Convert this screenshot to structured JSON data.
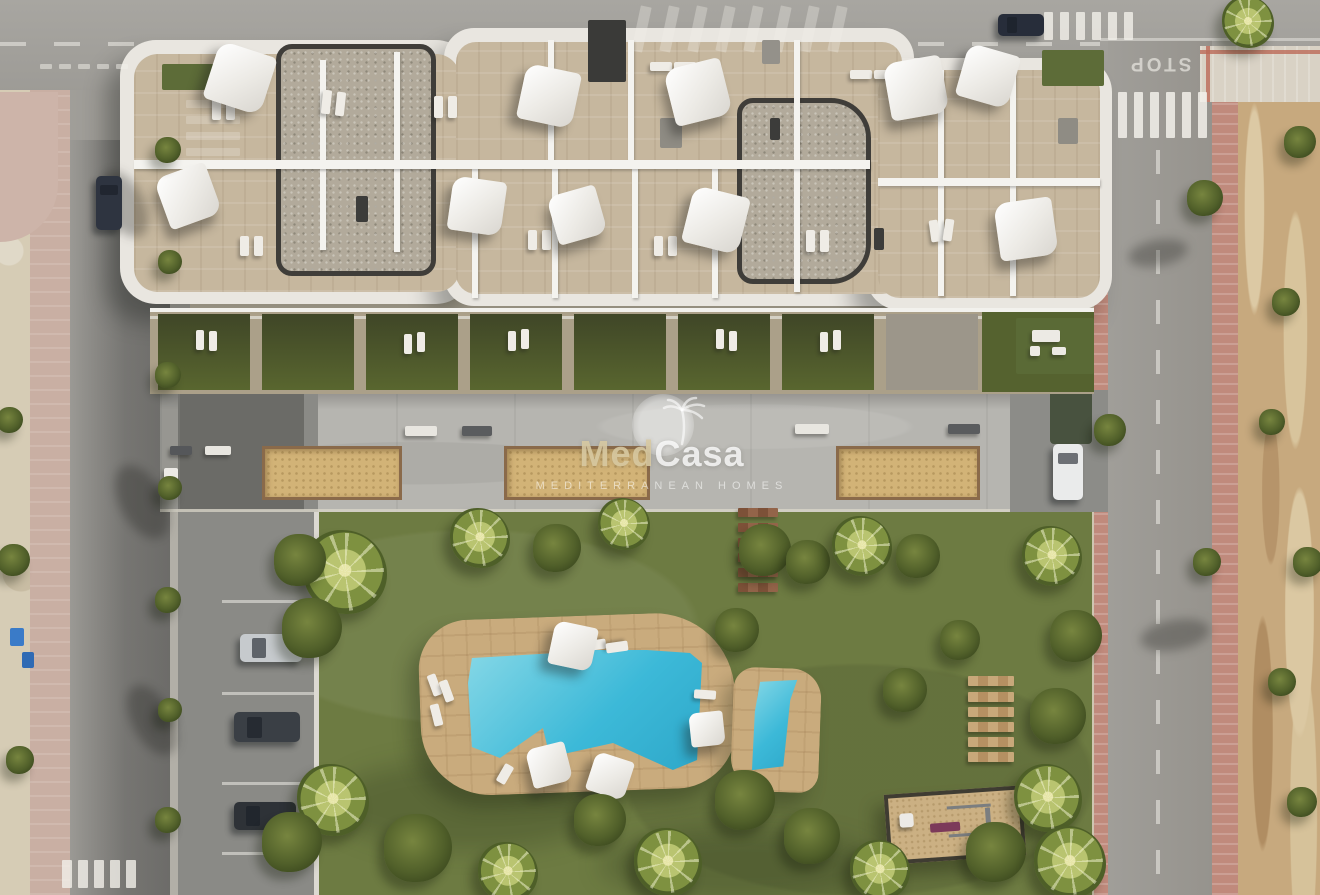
{
  "watermark": {
    "brand_part1": "Med",
    "brand_part2": "Casa",
    "tagline": "MEDITERRANEAN HOMES",
    "icon": "sun-palm-logo-icon",
    "brand_gold_color": "#d8c9a2",
    "watermark_white": "rgba(255,255,255,0.78)"
  },
  "road_markings": {
    "stop_text": "STOP"
  },
  "colors": {
    "pool_water": "#3cb9d8",
    "lawn": "#6d7b42",
    "pool_deck": "#c9ab7d",
    "planter_sand": "#d2b377",
    "roof_terrace": "#c6b79e",
    "roof_gravel": "#b2aa9b",
    "asphalt": "#9b9a96",
    "promenade": "#b6b5b0",
    "red_sidewalk": "#c08a7c",
    "vacant_dirt": "#c7a97e",
    "private_garden": "#4c5430",
    "fitness_bench_purple": "#7c3a5a"
  },
  "scene": {
    "parasols": [
      [
        240,
        78,
        60,
        18
      ],
      [
        188,
        196,
        54,
        -20
      ],
      [
        549,
        96,
        56,
        12
      ],
      [
        698,
        92,
        58,
        -14
      ],
      [
        477,
        206,
        54,
        8
      ],
      [
        577,
        215,
        50,
        -16
      ],
      [
        716,
        220,
        58,
        14
      ],
      [
        916,
        88,
        58,
        -10
      ],
      [
        988,
        76,
        54,
        16
      ],
      [
        1026,
        229,
        58,
        -8
      ],
      [
        573,
        646,
        44,
        12
      ],
      [
        549,
        765,
        40,
        -14
      ],
      [
        610,
        776,
        40,
        18
      ],
      [
        707,
        729,
        34,
        -6
      ]
    ],
    "loungers": [
      [
        212,
        96,
        9,
        24,
        0
      ],
      [
        226,
        96,
        9,
        24,
        0
      ],
      [
        322,
        90,
        9,
        24,
        6
      ],
      [
        336,
        92,
        9,
        24,
        6
      ],
      [
        434,
        96,
        9,
        22,
        0
      ],
      [
        448,
        96,
        9,
        22,
        0
      ],
      [
        650,
        62,
        22,
        9,
        0
      ],
      [
        674,
        62,
        22,
        9,
        0
      ],
      [
        850,
        70,
        22,
        9,
        0
      ],
      [
        874,
        70,
        22,
        9,
        0
      ],
      [
        806,
        230,
        9,
        22,
        0
      ],
      [
        820,
        230,
        9,
        22,
        0
      ],
      [
        240,
        236,
        9,
        20,
        0
      ],
      [
        254,
        236,
        9,
        20,
        0
      ],
      [
        930,
        220,
        9,
        22,
        -8
      ],
      [
        944,
        219,
        9,
        22,
        8
      ],
      [
        528,
        230,
        9,
        20,
        0
      ],
      [
        542,
        230,
        9,
        20,
        0
      ],
      [
        654,
        236,
        9,
        20,
        0
      ],
      [
        668,
        236,
        9,
        20,
        0
      ],
      [
        196,
        330,
        8,
        20,
        0
      ],
      [
        209,
        331,
        8,
        20,
        0
      ],
      [
        404,
        334,
        8,
        20,
        0
      ],
      [
        417,
        332,
        8,
        20,
        0
      ],
      [
        508,
        331,
        8,
        20,
        0
      ],
      [
        521,
        329,
        8,
        20,
        0
      ],
      [
        716,
        329,
        8,
        20,
        0
      ],
      [
        729,
        331,
        8,
        20,
        0
      ],
      [
        820,
        332,
        8,
        20,
        0
      ],
      [
        833,
        330,
        8,
        20,
        0
      ],
      [
        430,
        674,
        9,
        22,
        -20
      ],
      [
        442,
        680,
        9,
        22,
        -20
      ],
      [
        432,
        704,
        9,
        22,
        -14
      ],
      [
        590,
        634,
        10,
        22,
        82
      ],
      [
        612,
        636,
        10,
        22,
        82
      ],
      [
        694,
        690,
        22,
        9,
        4
      ],
      [
        500,
        764,
        10,
        20,
        30
      ]
    ],
    "vegetation": [
      [
        345,
        572,
        42,
        "p"
      ],
      [
        312,
        628,
        30,
        "b"
      ],
      [
        300,
        560,
        26,
        "b"
      ],
      [
        480,
        538,
        30,
        "p"
      ],
      [
        557,
        548,
        24,
        "b"
      ],
      [
        624,
        524,
        26,
        "p"
      ],
      [
        765,
        550,
        26,
        "b"
      ],
      [
        808,
        562,
        22,
        "b"
      ],
      [
        862,
        546,
        30,
        "p"
      ],
      [
        918,
        556,
        22,
        "b"
      ],
      [
        333,
        800,
        36,
        "p"
      ],
      [
        292,
        842,
        30,
        "b"
      ],
      [
        418,
        848,
        34,
        "b"
      ],
      [
        508,
        872,
        30,
        "p"
      ],
      [
        600,
        820,
        26,
        "b"
      ],
      [
        668,
        862,
        34,
        "p"
      ],
      [
        745,
        800,
        30,
        "b"
      ],
      [
        812,
        836,
        28,
        "b"
      ],
      [
        880,
        870,
        30,
        "p"
      ],
      [
        1052,
        556,
        30,
        "p"
      ],
      [
        1076,
        636,
        26,
        "b"
      ],
      [
        1058,
        716,
        28,
        "b"
      ],
      [
        1048,
        798,
        34,
        "p"
      ],
      [
        996,
        852,
        30,
        "b"
      ],
      [
        1070,
        862,
        36,
        "p"
      ],
      [
        737,
        630,
        22,
        "b"
      ],
      [
        960,
        640,
        20,
        "b"
      ],
      [
        905,
        690,
        22,
        "b"
      ],
      [
        168,
        150,
        13,
        "b"
      ],
      [
        170,
        262,
        12,
        "b"
      ],
      [
        168,
        375,
        13,
        "b"
      ],
      [
        170,
        488,
        12,
        "b"
      ],
      [
        168,
        600,
        13,
        "b"
      ],
      [
        170,
        710,
        12,
        "b"
      ],
      [
        168,
        820,
        13,
        "b"
      ],
      [
        14,
        560,
        16,
        "b"
      ],
      [
        20,
        760,
        14,
        "b"
      ],
      [
        10,
        420,
        13,
        "b"
      ],
      [
        1110,
        430,
        16,
        "b"
      ],
      [
        1205,
        198,
        18,
        "b"
      ],
      [
        1207,
        562,
        14,
        "b"
      ],
      [
        1248,
        22,
        26,
        "p"
      ],
      [
        1300,
        142,
        16,
        "b"
      ],
      [
        1286,
        302,
        14,
        "b"
      ],
      [
        1272,
        422,
        13,
        "b"
      ],
      [
        1308,
        562,
        15,
        "b"
      ],
      [
        1282,
        682,
        14,
        "b"
      ],
      [
        1302,
        802,
        15,
        "b"
      ]
    ],
    "cars": [
      [
        96,
        176,
        26,
        54,
        "#2e3440",
        "v"
      ],
      [
        998,
        14,
        46,
        22,
        "#272d3a",
        "h"
      ],
      [
        240,
        634,
        62,
        28,
        "#c6cacd",
        "h"
      ],
      [
        234,
        712,
        66,
        30,
        "#3a3f45",
        "h"
      ],
      [
        234,
        802,
        62,
        28,
        "#2e3237",
        "h"
      ],
      [
        1053,
        444,
        30,
        56,
        "#eaebeb",
        "v"
      ]
    ],
    "planters": [
      [
        262,
        446,
        134,
        48
      ],
      [
        504,
        446,
        140,
        48
      ],
      [
        836,
        446,
        138,
        48
      ]
    ],
    "benches": [
      [
        405,
        426,
        32,
        10,
        "#e8e6e0"
      ],
      [
        462,
        426,
        30,
        10,
        "#5a5c5e"
      ],
      [
        205,
        446,
        26,
        9,
        "#e8e6e0"
      ],
      [
        170,
        446,
        22,
        9,
        "#55575a"
      ],
      [
        164,
        468,
        14,
        26,
        "#eceae6"
      ],
      [
        795,
        424,
        34,
        10,
        "#e8e6e0"
      ],
      [
        948,
        424,
        32,
        10,
        "#5a5c5e"
      ],
      [
        1032,
        330,
        28,
        12,
        "#eceae4"
      ],
      [
        1030,
        346,
        10,
        10,
        "#eceae4"
      ],
      [
        1052,
        347,
        14,
        8,
        "#eceae4"
      ]
    ],
    "bins": [
      [
        10,
        628,
        14,
        18,
        "#3a7bc8"
      ],
      [
        22,
        652,
        12,
        16,
        "#2f6ab4"
      ]
    ],
    "garden_cells": [
      [
        158,
        314,
        92,
        76,
        "lawncell"
      ],
      [
        262,
        314,
        92,
        76,
        "lawncell"
      ],
      [
        366,
        314,
        92,
        76,
        "lawncell"
      ],
      [
        470,
        314,
        92,
        76,
        "lawncell"
      ],
      [
        574,
        314,
        92,
        76,
        "lawncell"
      ],
      [
        678,
        314,
        92,
        76,
        "lawncell"
      ],
      [
        782,
        314,
        92,
        76,
        "lawncell"
      ],
      [
        886,
        314,
        92,
        76,
        "stone"
      ],
      [
        982,
        312,
        112,
        80,
        "green"
      ]
    ],
    "partitions": [
      [
        320,
        60,
        6,
        190
      ],
      [
        394,
        52,
        6,
        200
      ],
      [
        548,
        40,
        6,
        122
      ],
      [
        628,
        40,
        6,
        122
      ],
      [
        472,
        166,
        6,
        132
      ],
      [
        552,
        166,
        6,
        132
      ],
      [
        632,
        166,
        6,
        132
      ],
      [
        712,
        166,
        6,
        132
      ],
      [
        794,
        40,
        6,
        252
      ],
      [
        938,
        70,
        6,
        110
      ],
      [
        1010,
        70,
        6,
        110
      ],
      [
        938,
        186,
        6,
        110
      ],
      [
        1010,
        186,
        6,
        110
      ],
      [
        134,
        160,
        736,
        9
      ],
      [
        878,
        178,
        222,
        8
      ]
    ],
    "roof_objects": [
      [
        660,
        118,
        22,
        30,
        "#8f8c84"
      ],
      [
        762,
        40,
        18,
        24,
        "#94918a"
      ],
      [
        1058,
        118,
        20,
        26,
        "#8f8c84"
      ],
      [
        356,
        196,
        12,
        26,
        "#3c3c3a"
      ],
      [
        726,
        196,
        12,
        26,
        "#3c3c3a"
      ],
      [
        770,
        118,
        10,
        22,
        "#3c3c3a"
      ],
      [
        874,
        228,
        10,
        22,
        "#3c3c3a"
      ],
      [
        588,
        20,
        38,
        62,
        "#3a3a38"
      ],
      [
        162,
        64,
        52,
        26,
        "#5d6c38"
      ],
      [
        1042,
        50,
        62,
        36,
        "#5d6c38"
      ],
      [
        1016,
        318,
        78,
        56,
        "#5a6a36"
      ]
    ],
    "plank_sets": [
      {
        "x": 738,
        "w": 40,
        "h": 9,
        "colors": [
          "#7d5138",
          "#936449"
        ],
        "ys": [
          508,
          523,
          538,
          553,
          568,
          583
        ]
      },
      {
        "x": 968,
        "w": 46,
        "h": 10,
        "colors": [
          "#c8a87a",
          "#b59062"
        ],
        "ys": [
          676,
          692,
          707,
          722,
          737,
          752
        ]
      }
    ],
    "stripe_groups": [
      {
        "x": 636,
        "y": 6,
        "w": 11,
        "h": 46,
        "gap": 17,
        "count": 8,
        "axis": "x",
        "opacity": 0.32,
        "rot": 12
      },
      {
        "x": 1044,
        "y": 12,
        "w": 9,
        "h": 28,
        "gap": 7,
        "count": 6,
        "axis": "x",
        "opacity": 0.8,
        "rot": 0
      },
      {
        "x": 1118,
        "y": 92,
        "w": 9,
        "h": 46,
        "gap": 7,
        "count": 6,
        "axis": "x",
        "opacity": 0.85,
        "rot": 0
      },
      {
        "x": 62,
        "y": 860,
        "w": 10,
        "h": 28,
        "gap": 6,
        "count": 5,
        "axis": "x",
        "opacity": 0.8,
        "rot": 0
      },
      {
        "x": 40,
        "y": 64,
        "w": 12,
        "h": 5,
        "gap": 7,
        "count": 5,
        "axis": "x",
        "opacity": 0.5,
        "rot": 0
      },
      {
        "x": 186,
        "y": 100,
        "w": 54,
        "h": 8,
        "gap": 8,
        "count": 4,
        "axis": "y",
        "opacity": 0.25,
        "rot": 0
      }
    ],
    "bay_lines": {
      "x": 222,
      "w": 92,
      "h": 3,
      "ys": [
        600,
        692,
        782,
        852
      ]
    },
    "tree_shadows": [
      [
        104,
        168,
        40,
        72,
        -28
      ],
      [
        120,
        462,
        44,
        80,
        -28
      ],
      [
        132,
        682,
        40,
        76,
        -28
      ],
      [
        1128,
        240,
        60,
        26,
        -10
      ],
      [
        1140,
        620,
        70,
        30,
        -10
      ]
    ]
  }
}
